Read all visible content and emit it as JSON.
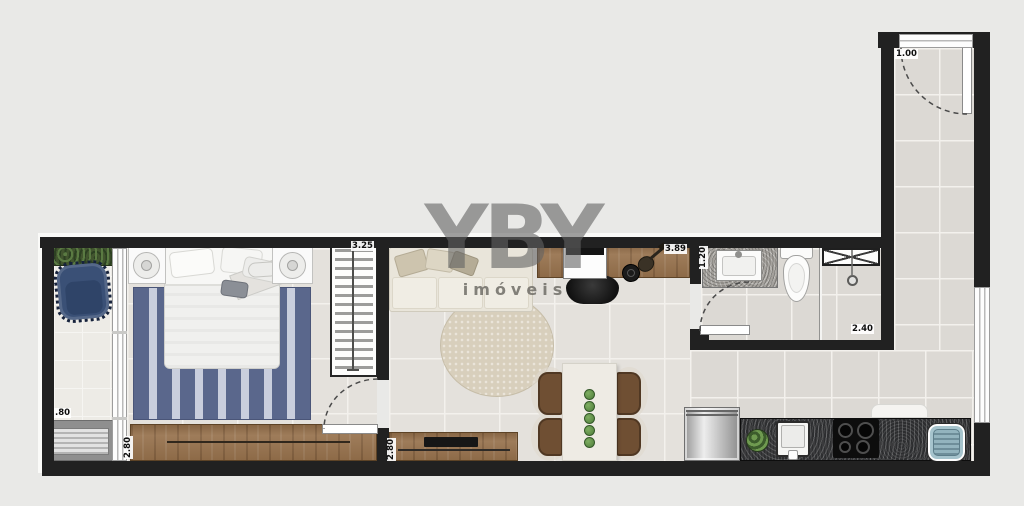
{
  "watermark": {
    "brand": "YBY",
    "subtitle": "imóveis"
  },
  "dimensions": {
    "balcony_width": ".80",
    "bedroom_closet_wall": "3.25",
    "bedroom_depth": "2.80",
    "living_depth": "2.80",
    "living_width": "3.89",
    "bathroom_vanity_wall": "1.20",
    "bathroom_depth": "2.40",
    "entry_hall_width": "1.00"
  },
  "colors": {
    "background": "#e9e9e7",
    "wall": "#212121",
    "wood": "#96714c",
    "counter": "#2d2e30",
    "rug_blue": "#5a678c",
    "rug_blue_light": "#c9cedd",
    "sofa_cream": "#e9e5da",
    "round_rug": "#d8cfbc",
    "chair_brown": "#6f4f33",
    "accent_green": "#4e7d3a",
    "appliance_blue": "#a6c4cd",
    "hedge_green": "#42552f",
    "armchair_navy": "#3a5076"
  }
}
